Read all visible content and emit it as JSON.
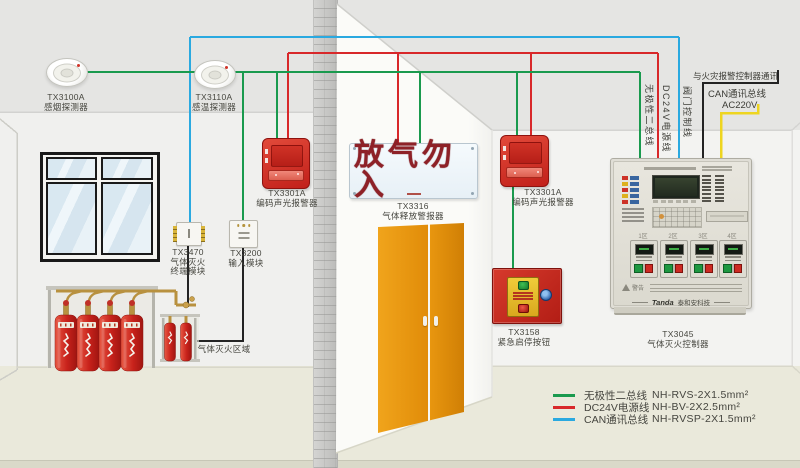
{
  "diagram": {
    "detectors": [
      {
        "model": "TX3100A",
        "type": "感烟探测器"
      },
      {
        "model": "TX3110A",
        "type": "感温探测器"
      }
    ],
    "alarms": [
      {
        "model": "TX3301A",
        "type": "编码声光报警器"
      },
      {
        "model": "TX3301A",
        "type": "编码声光报警器"
      }
    ],
    "modules": [
      {
        "model": "TX3470",
        "line1": "气体灭火",
        "line2": "终端模块"
      },
      {
        "model": "TX3200",
        "type": "输入模块"
      }
    ],
    "release_sign": {
      "text": "放气勿入",
      "model": "TX3316",
      "type": "气体释放警报器"
    },
    "emergency_button": {
      "model": "TX3158",
      "type": "紧急启停按钮"
    },
    "controller": {
      "model": "TX3045",
      "type": "气体灭火控制器",
      "brand": "Tanda",
      "brand_cn": "泰和安科技",
      "warning": "警告",
      "zones": [
        "1区",
        "2区",
        "3区",
        "4区"
      ]
    },
    "area_label": "气体灭火区域",
    "wire_labels": {
      "bus": "无极性二总线",
      "power": "DC24V电源线",
      "valve": "阀门控制线",
      "comm": "与火灾报警控制器通讯",
      "can": "CAN通讯总线",
      "ac": "AC220V"
    },
    "legend": [
      {
        "label": "无极性二总线",
        "spec": "NH-RVS-2X1.5mm²",
        "color": "#1a9a4e"
      },
      {
        "label": "DC24V电源线",
        "spec": "NH-BV-2X2.5mm²",
        "color": "#d8282a"
      },
      {
        "label": "CAN通讯总线",
        "spec": "NH-RVSP-2X1.5mm²",
        "color": "#2aa9e0"
      }
    ],
    "colors": {
      "wire_green": "#1a9a4e",
      "wire_red": "#d8282a",
      "wire_blue": "#2aa9e0",
      "wire_black": "#232323",
      "wire_yellow": "#eed520",
      "door_orange": "#e8940f",
      "alarm_red": "#cf2a22"
    }
  }
}
